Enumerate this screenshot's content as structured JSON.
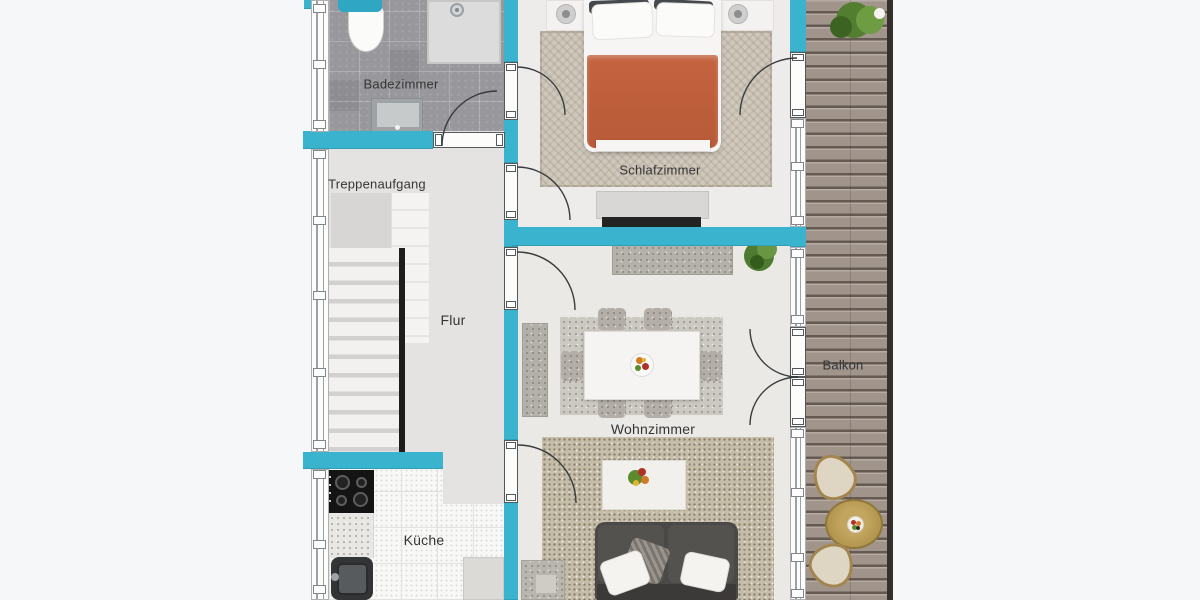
{
  "rooms": {
    "badezimmer": {
      "label": "Badezimmer"
    },
    "schlafzimmer": {
      "label": "Schlafzimmer"
    },
    "treppenaufgang": {
      "label": "Treppenaufgang"
    },
    "flur": {
      "label": "Flur"
    },
    "wohnzimmer": {
      "label": "Wohnzimmer"
    },
    "kueche": {
      "label": "Küche"
    },
    "balkon": {
      "label": "Balkon"
    }
  },
  "colors": {
    "wall": "#3ab4ce",
    "background": "#f6f7f9",
    "deck": "#a1958b",
    "blanket": "#b85a38",
    "sofa": "#4b4947"
  }
}
